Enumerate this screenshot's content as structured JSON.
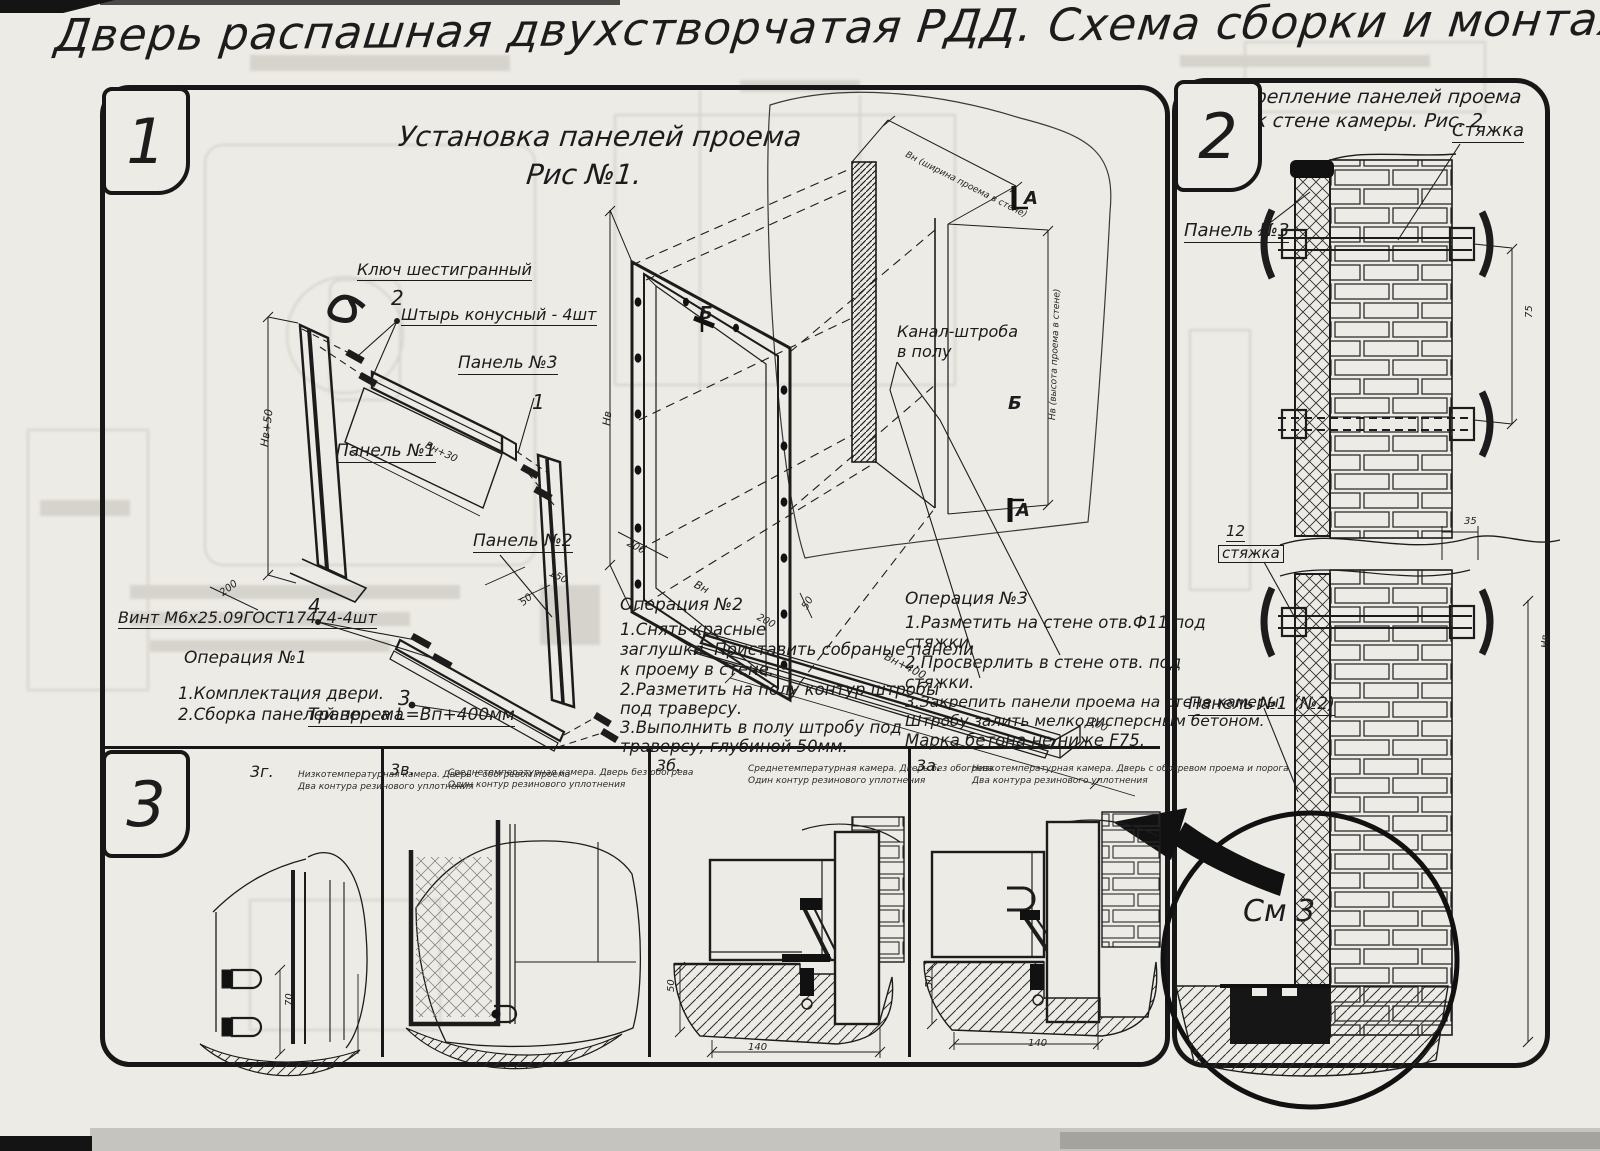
{
  "title": "Дверь распашная двухстворчатая РДД.  Схема сборки и монтажа №2",
  "fig1": {
    "badge": "1",
    "title1": "Установка панелей проема",
    "title2": "Рис №1.",
    "labels": {
      "hexkey": "Ключ шестигранный",
      "pin_no": "2",
      "pin": "Штырь конусный - 4шт",
      "panel3": "Панель №3",
      "panel1": "Панель №1",
      "panel2": "Панель №2",
      "callout1": "1",
      "callout4": "4",
      "screw": "Винт М6х25.09ГОСТ17474-4шт",
      "callout3": "3",
      "traverse": "Траверса  L=Вп+400мм",
      "channel1": "Канал-штроба",
      "channel2": "в полу",
      "secA": "А",
      "secB": "Б"
    },
    "dims": {
      "d1": "Нв+50",
      "d2": "200",
      "d3": "Вн+30",
      "d4": "50",
      "d5": "150",
      "d6": "Нв",
      "d7": "200",
      "d8": "Вн",
      "d9": "200",
      "d10": "50",
      "d11": "Вн+400",
      "d12": "200",
      "d13": "Вн (ширина проема в стене)",
      "d14": "Нв (высота проема в стене)"
    },
    "op1": {
      "t": "Операция №1",
      "l1": "1.Комплектация двери.",
      "l2": "2.Сборка панелей проема"
    },
    "op2": {
      "t": "Операция №2",
      "l1": "1.Снять красные",
      "l2": "заглушки. Приставить собраные панели",
      "l3": "к проему в стене.",
      "l4": "2.Разметить на полу контур штробы",
      "l5": "под траверсу.",
      "l6": "3.Выполнить в полу штробу под",
      "l7": "траверсу, глубиной 50мм."
    },
    "op3": {
      "t": "Операция №3",
      "l1": "1.Разметить на стене отв.Ф11 под",
      "l2": "стяжки.",
      "l3": "2.Просверлить в стене отв.  под",
      "l4": "стяжки.",
      "l5": "3.Закрепить панели проема на стене камеры.",
      "l6": "Штробу залить мелкодисперсным бетоном.",
      "l7": "Марка бетона не ниже  F75."
    }
  },
  "fig2": {
    "badge": "2",
    "title1": "Крепление панелей проема",
    "title2": "к стене камеры. Рис. 2",
    "labels": {
      "tie": "Стяжка",
      "panel3": "Панель №3",
      "tie_no": "12",
      "tie2": "стяжка",
      "panel12": "Панель №1 (№2)",
      "see": "См 3"
    },
    "dims": {
      "d35": "35",
      "d75": "75",
      "dHv": "Нв"
    }
  },
  "fig3": {
    "badge": "3",
    "cells": [
      {
        "label": "3г.",
        "cap1": "Низкотемпературная камера. Дверь с обогревом проема",
        "cap2": "Два контура резинового уплотнения",
        "dimv": "70"
      },
      {
        "label": "3в.",
        "cap1": "Среднетемпературная камера. Дверь без обогрева",
        "cap2": "Один контур резинового уплотнения"
      },
      {
        "label": "3б.",
        "cap1": "Среднетемпературная камера. Дверь без обогрева",
        "cap2": "Один контур резинового уплотнения",
        "dimv": "50",
        "dimh": "140"
      },
      {
        "label": "3а.",
        "cap1": "Низкотемпературная камера. Дверь с обогревом проема и порога",
        "cap2": "Два контура резинового уплотнения",
        "dimv": "50",
        "dimh": "140"
      }
    ]
  }
}
